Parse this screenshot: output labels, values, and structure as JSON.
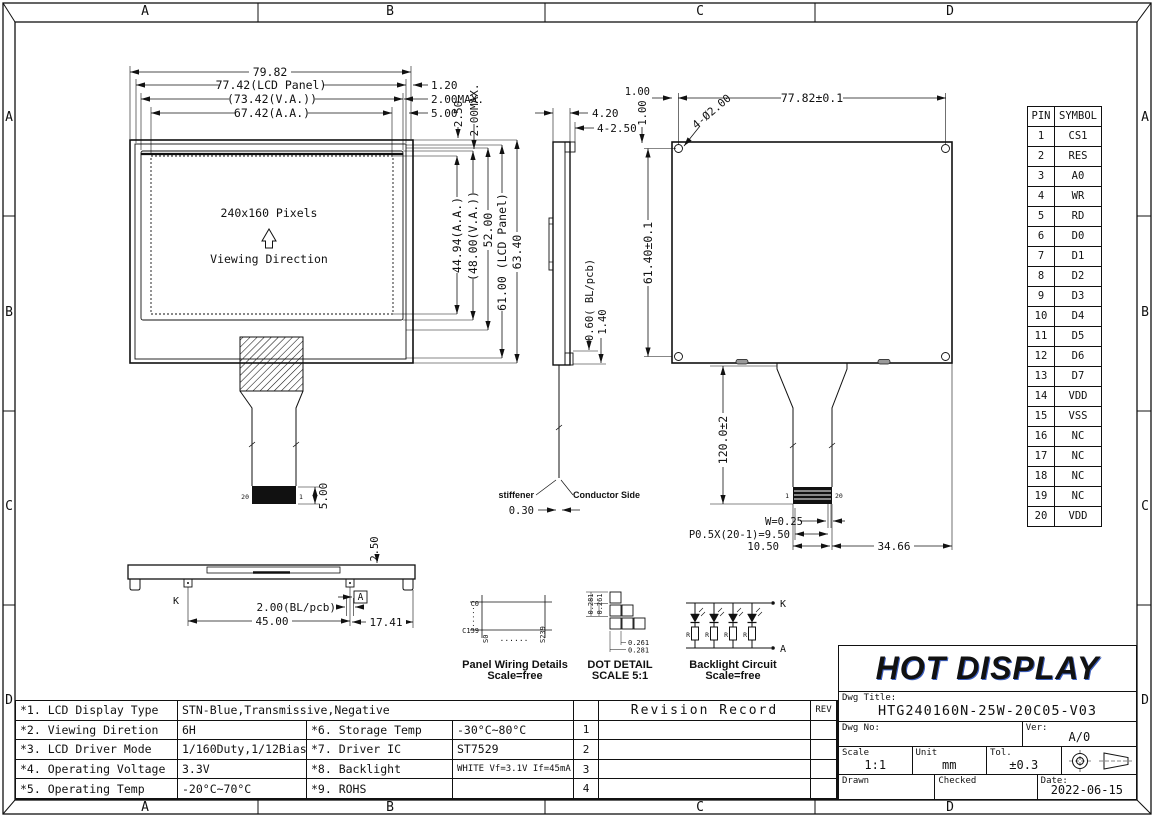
{
  "zones": {
    "a": "A",
    "b": "B",
    "c": "C",
    "d": "D"
  },
  "front": {
    "w_overall": "79.82",
    "w_panel": "77.42(LCD Panel)",
    "w_va": "(73.42(V.A.))",
    "w_aa": "67.42(A.A.)",
    "gap_120": "1.20",
    "gap_200a": "2.00MAX.",
    "gap_500": "5.00",
    "gap_250": "2.50",
    "gap_200b": "2.00MAX.",
    "h_aa": "44.94(A.A.)",
    "h_va": "(48.00(V.A.))",
    "h_52": "52.00",
    "h_panel": "61.00 (LCD Panel)",
    "h_overall": "63.40",
    "pixels": "240x160 Pixels",
    "viewing": "Viewing Direction",
    "pin20": "20",
    "pin1": "1",
    "conn_h": "5.00"
  },
  "side": {
    "t_420": "4.20",
    "t_4250": "4-2.50",
    "bl": "0.60( BL/pcb)",
    "d_140": "1.40",
    "stiffener": "stiffener",
    "conductor": "Conductor Side",
    "d_030": "0.30"
  },
  "back": {
    "off_h": "1.00",
    "off_v": "1.00",
    "holes": "4-Ø2.00",
    "w": "77.82±0.1",
    "h": "61.40±0.1",
    "fpc_len": "120.0±2",
    "pin1": "1",
    "pin20": "20",
    "pin_w": "W=0.25",
    "pitch": "P0.5X(20-1)=9.50",
    "conn_w": "10.50",
    "d_3466": "34.66"
  },
  "bottom": {
    "t_250": "2.50",
    "k": "K",
    "a": "A",
    "bl": "2.00(BL/pcb)",
    "d_45": "45.00",
    "d_1741": "17.41"
  },
  "details": {
    "wiring": {
      "c0": "C0",
      "c159": "C159",
      "s0": "S0",
      "s239": "S239",
      "vdots": "......",
      "hdots": "......",
      "cap": "Panel Wiring Details",
      "scale": "Scale=free"
    },
    "dot": {
      "p1": "0.281",
      "p2": "0.261",
      "p3": "0.261",
      "p4": "0.281",
      "cap": "DOT DETAIL",
      "scale": "SCALE 5:1"
    },
    "backlight": {
      "k": "K",
      "a": "A",
      "r": "R",
      "cap": "Backlight Circuit",
      "scale": "Scale=free"
    }
  },
  "pin_table": {
    "h1": "PIN",
    "h2": "SYMBOL",
    "rows": [
      [
        "1",
        "CS1"
      ],
      [
        "2",
        "RES"
      ],
      [
        "3",
        "A0"
      ],
      [
        "4",
        "WR"
      ],
      [
        "5",
        "RD"
      ],
      [
        "6",
        "D0"
      ],
      [
        "7",
        "D1"
      ],
      [
        "8",
        "D2"
      ],
      [
        "9",
        "D3"
      ],
      [
        "10",
        "D4"
      ],
      [
        "11",
        "D5"
      ],
      [
        "12",
        "D6"
      ],
      [
        "13",
        "D7"
      ],
      [
        "14",
        "VDD"
      ],
      [
        "15",
        "VSS"
      ],
      [
        "16",
        "NC"
      ],
      [
        "17",
        "NC"
      ],
      [
        "18",
        "NC"
      ],
      [
        "19",
        "NC"
      ],
      [
        "20",
        "VDD"
      ]
    ]
  },
  "spec": {
    "r1l": "*1. LCD Display Type",
    "r1v": "STN-Blue,Transmissive,Negative",
    "r2l": "*2. Viewing Diretion",
    "r2v": "6H",
    "r2l2": "*6. Storage Temp",
    "r2v2": "-30°C~80°C",
    "r3l": "*3. LCD Driver Mode",
    "r3v": "1/160Duty,1/12Bias",
    "r3l2": "*7. Driver IC",
    "r3v2": "ST7529",
    "r4l": "*4. Operating Voltage",
    "r4v": "3.3V",
    "r4l2": "*8. Backlight",
    "r4v2": "WHITE Vf=3.1V If=45mA",
    "r5l": "*5. Operating Temp",
    "r5v": "-20°C~70°C",
    "r5l2": "*9. ROHS",
    "r5v2": ""
  },
  "revision": {
    "title": "Revision Record",
    "rev": "REV",
    "n1": "1",
    "n2": "2",
    "n3": "3",
    "n4": "4"
  },
  "title_block": {
    "logo": "HOT DISPLAY",
    "dwg_title_label": "Dwg Title:",
    "dwg_title": "HTG240160N-25W-20C05-V03",
    "dwg_no_label": "Dwg No:",
    "ver_label": "Ver:",
    "ver": "A/0",
    "scale_label": "Scale",
    "scale": "1:1",
    "unit_label": "Unit",
    "unit": "mm",
    "tol_label": "Tol.",
    "tol": "±0.3",
    "drawn_label": "Drawn",
    "checked_label": "Checked",
    "date_label": "Date:",
    "date": "2022-06-15"
  }
}
